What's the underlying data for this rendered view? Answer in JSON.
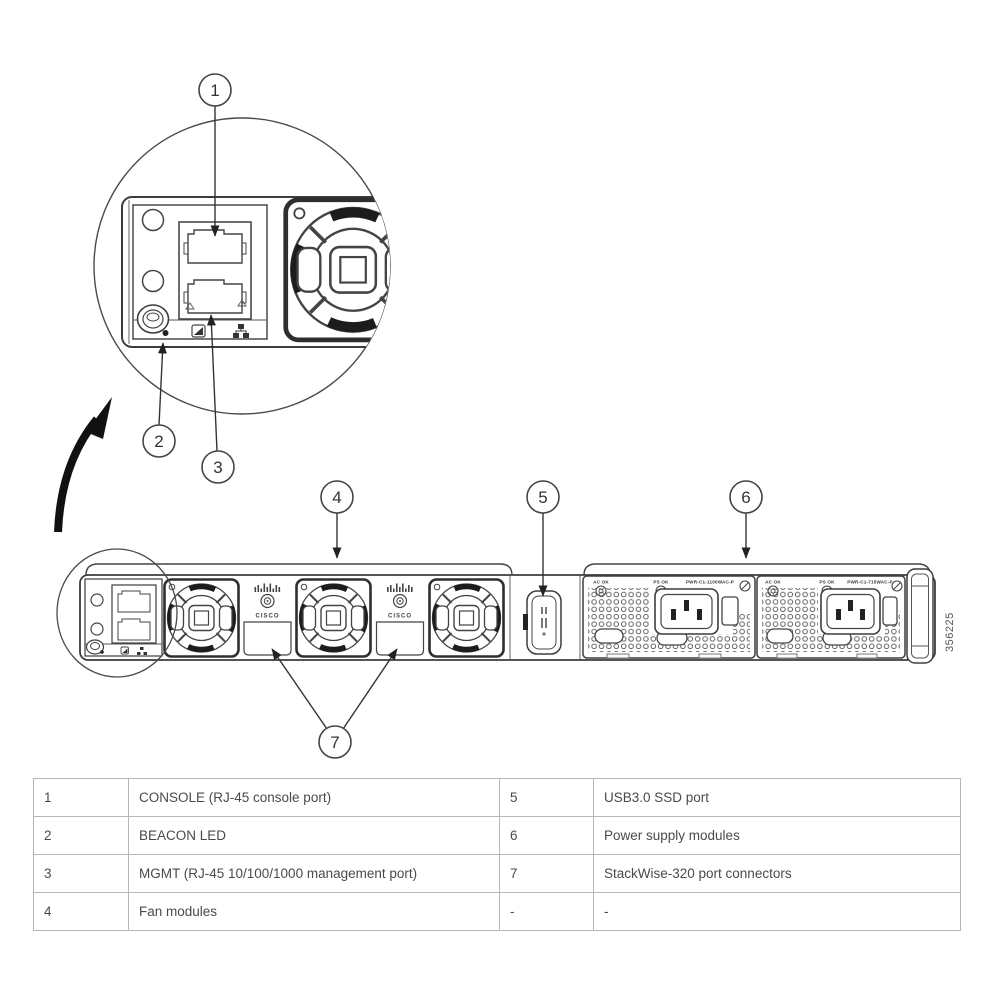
{
  "figure": {
    "callouts": [
      "1",
      "2",
      "3",
      "4",
      "5",
      "6",
      "7"
    ],
    "brand": "CISCO",
    "psu": {
      "ac_ok": "AC OK",
      "ps_ok": "PS OK",
      "model_left": "PWR-C1-1100WAC-P",
      "model_right": "PWR-C1-715WAC-P"
    },
    "figure_id": "356225"
  },
  "legend": {
    "rows": [
      [
        "1",
        "CONSOLE (RJ-45 console port)",
        "5",
        "USB3.0 SSD port"
      ],
      [
        "2",
        "BEACON LED",
        "6",
        "Power supply modules"
      ],
      [
        "3",
        "MGMT (RJ-45 10/100/1000 management port)",
        "7",
        "StackWise-320 port connectors"
      ],
      [
        "4",
        "Fan modules",
        "-",
        "-"
      ]
    ]
  }
}
